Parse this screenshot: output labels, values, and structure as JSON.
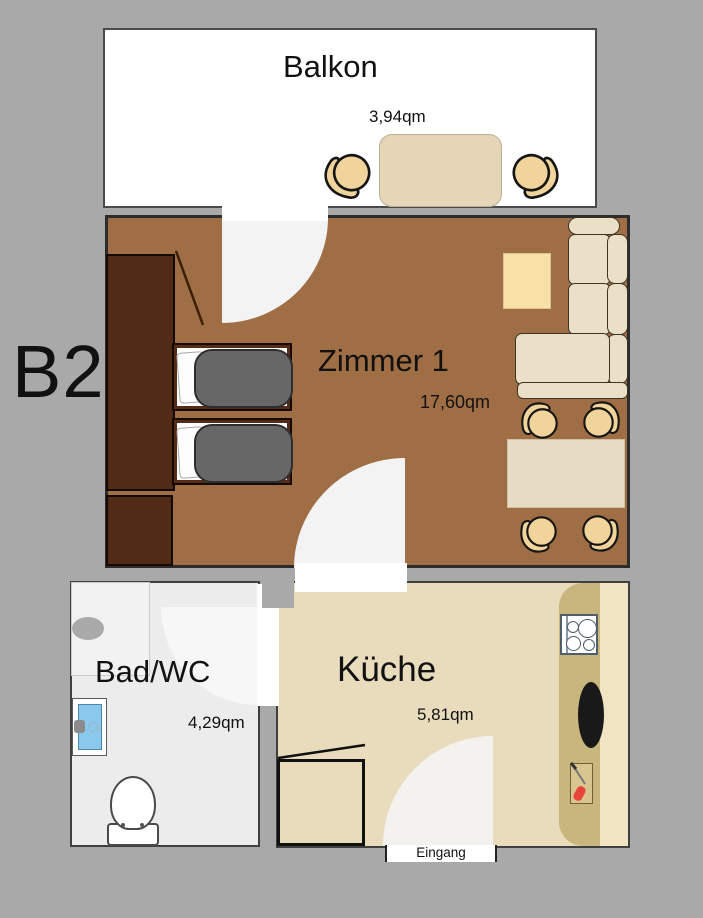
{
  "plan": {
    "unit_label": "B2",
    "entrance_label": "Eingang"
  },
  "rooms": {
    "balkon": {
      "name": "Balkon",
      "area": "3,94qm"
    },
    "zimmer1": {
      "name": "Zimmer 1",
      "area": "17,60qm"
    },
    "bad": {
      "name": "Bad/WC",
      "area": "4,29qm"
    },
    "kueche": {
      "name": "Küche",
      "area": "5,81qm"
    }
  },
  "colors": {
    "background": "#a9a9a9",
    "balcony_floor": "#ffffff",
    "zimmer_floor": "#9f6e45",
    "bath_floor": "#ececec",
    "kitchen_floor": "#e9dcbd",
    "wardrobe_wood": "#522b16",
    "duvet_gray": "#676767",
    "sofa_cream": "#eae0c8",
    "chair_tan": "#f0d49c",
    "counter_khaki": "#c8b67d",
    "shower_blue": "#8ac9ec",
    "food_red": "#e8443a"
  }
}
